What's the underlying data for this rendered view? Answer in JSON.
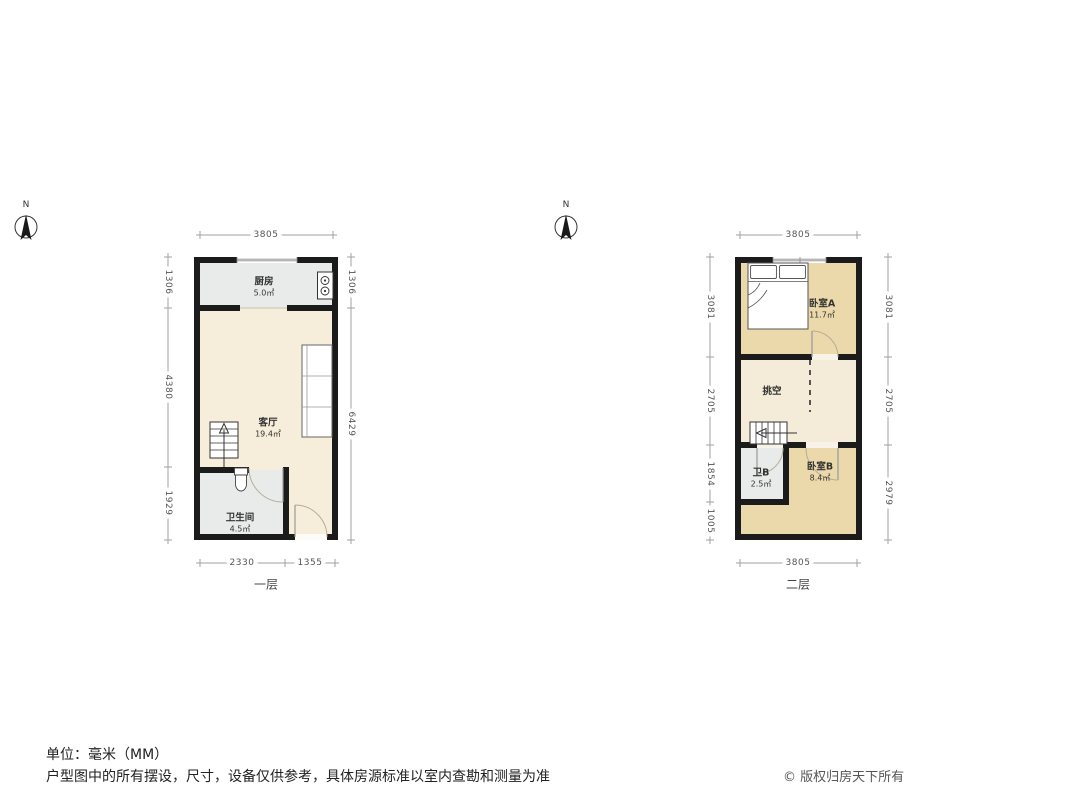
{
  "meta": {
    "unit_note": "单位：毫米（MM）",
    "disclaimer": "户型图中的所有摆设，尺寸，设备仅供参考，具体房源标准以室内查勘和测量为准",
    "copyright": "© 版权归房天下所有"
  },
  "compass": {
    "label": "N"
  },
  "colors": {
    "wall": "#1b1b1b",
    "living_floor": "#f6eeda",
    "bedroom_floor": "#ecd9ab",
    "void_floor": "#f4ecd8",
    "wet_floor": "#e9ebea",
    "dimension_line": "#a0a0a0"
  },
  "plans": [
    {
      "floor_label": "一层",
      "rooms": [
        {
          "name": "厨房",
          "area": "5.0㎡"
        },
        {
          "name": "客厅",
          "area": "19.4㎡"
        },
        {
          "name": "卫生间",
          "area": "4.5㎡"
        }
      ],
      "dims": {
        "top": [
          "3805"
        ],
        "left": [
          "1306",
          "4380",
          "1929"
        ],
        "right": [
          "1306",
          "6429"
        ],
        "bottom": [
          "2330",
          "1355"
        ]
      }
    },
    {
      "floor_label": "二层",
      "rooms": [
        {
          "name": "卧室A",
          "area": "11.7㎡"
        },
        {
          "name": "挑空",
          "area": ""
        },
        {
          "name": "卫B",
          "area": "2.5㎡"
        },
        {
          "name": "卧室B",
          "area": "8.4㎡"
        }
      ],
      "dims": {
        "top": [
          "3805"
        ],
        "left": [
          "3081",
          "2705",
          "1854",
          "1005"
        ],
        "right": [
          "3081",
          "2705",
          "2979"
        ],
        "bottom": [
          "3805"
        ]
      }
    }
  ]
}
